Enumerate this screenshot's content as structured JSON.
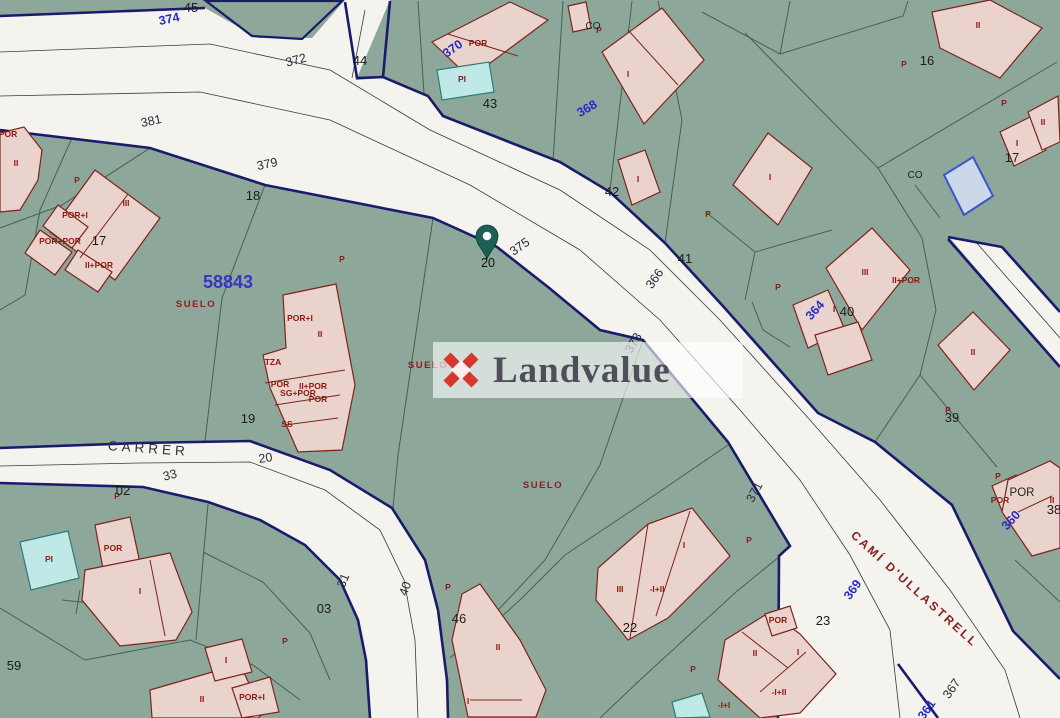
{
  "watermark": {
    "text": "Landvalue",
    "logo_color": "#d6372e",
    "text_color": "#4f4f5c"
  },
  "pin": {
    "label": "20",
    "x": 487,
    "y": 240,
    "color": "#1b5f55"
  },
  "reference_number": {
    "text": "58843",
    "x": 228,
    "y": 288,
    "color": "#3a35c0"
  },
  "street_names": [
    {
      "text": "CARRER",
      "x": 148,
      "y": 453,
      "rot": 4
    },
    {
      "text": "CAMÍ D'ULLASTRELL",
      "x": 912,
      "y": 592,
      "rot": 42
    }
  ],
  "land_use_labels": [
    {
      "text": "SUELO",
      "x": 196,
      "y": 307
    },
    {
      "text": "SUELO",
      "x": 428,
      "y": 368
    },
    {
      "text": "SUELO",
      "x": 543,
      "y": 488
    }
  ],
  "road_numbers": [
    {
      "t": "374",
      "x": 170,
      "y": 23,
      "r": -12,
      "c": "blue"
    },
    {
      "t": "372",
      "x": 297,
      "y": 64,
      "r": -15,
      "c": "dark"
    },
    {
      "t": "381",
      "x": 152,
      "y": 125,
      "r": -12,
      "c": "dark"
    },
    {
      "t": "379",
      "x": 268,
      "y": 168,
      "r": -12,
      "c": "dark"
    },
    {
      "t": "370",
      "x": 455,
      "y": 52,
      "r": -35,
      "c": "blue"
    },
    {
      "t": "368",
      "x": 589,
      "y": 112,
      "r": -30,
      "c": "blue"
    },
    {
      "t": "375",
      "x": 522,
      "y": 250,
      "r": -35,
      "c": "dark"
    },
    {
      "t": "366",
      "x": 658,
      "y": 281,
      "r": -55,
      "c": "dark"
    },
    {
      "t": "373",
      "x": 637,
      "y": 345,
      "r": -60,
      "c": "dark"
    },
    {
      "t": "364",
      "x": 818,
      "y": 313,
      "r": -48,
      "c": "blue"
    },
    {
      "t": "371",
      "x": 758,
      "y": 494,
      "r": -62,
      "c": "dark"
    },
    {
      "t": "369",
      "x": 856,
      "y": 592,
      "r": -55,
      "c": "blue"
    },
    {
      "t": "367",
      "x": 955,
      "y": 691,
      "r": -55,
      "c": "dark"
    },
    {
      "t": "361",
      "x": 930,
      "y": 712,
      "r": -55,
      "c": "blue"
    },
    {
      "t": "360",
      "x": 1014,
      "y": 523,
      "r": -48,
      "c": "blue"
    },
    {
      "t": "20",
      "x": 266,
      "y": 462,
      "r": -8,
      "c": "dark"
    },
    {
      "t": "33",
      "x": 171,
      "y": 479,
      "r": -15,
      "c": "dark"
    },
    {
      "t": "31",
      "x": 347,
      "y": 582,
      "r": -68,
      "c": "dark"
    },
    {
      "t": "40",
      "x": 409,
      "y": 590,
      "r": -70,
      "c": "dark"
    }
  ],
  "parcel_numbers": [
    {
      "t": "45",
      "x": 191,
      "y": 12
    },
    {
      "t": "44",
      "x": 360,
      "y": 65
    },
    {
      "t": "43",
      "x": 490,
      "y": 108
    },
    {
      "t": "42",
      "x": 612,
      "y": 196
    },
    {
      "t": "41",
      "x": 685,
      "y": 263
    },
    {
      "t": "40",
      "x": 847,
      "y": 316
    },
    {
      "t": "39",
      "x": 952,
      "y": 422
    },
    {
      "t": "16",
      "x": 927,
      "y": 65
    },
    {
      "t": "17",
      "x": 1012,
      "y": 162
    },
    {
      "t": "17",
      "x": 99,
      "y": 245
    },
    {
      "t": "18",
      "x": 253,
      "y": 200
    },
    {
      "t": "19",
      "x": 248,
      "y": 423
    },
    {
      "t": "02",
      "x": 123,
      "y": 495
    },
    {
      "t": "03",
      "x": 324,
      "y": 613
    },
    {
      "t": "59",
      "x": 14,
      "y": 670
    },
    {
      "t": "46",
      "x": 459,
      "y": 623
    },
    {
      "t": "23",
      "x": 823,
      "y": 625
    },
    {
      "t": "22",
      "x": 630,
      "y": 632
    },
    {
      "t": "38",
      "x": 1054,
      "y": 514
    }
  ],
  "pin_parcel_number": {
    "t": "20",
    "x": 488,
    "y": 267
  },
  "co_labels": [
    {
      "t": "CO",
      "x": 593,
      "y": 29
    },
    {
      "t": "CO",
      "x": 915,
      "y": 178
    }
  ],
  "por_black_label": {
    "t": "POR",
    "x": 1022,
    "y": 496
  },
  "building_labels": [
    {
      "t": "POR",
      "x": 8,
      "y": 137
    },
    {
      "t": "II",
      "x": 16,
      "y": 166
    },
    {
      "t": "P",
      "x": 77,
      "y": 183
    },
    {
      "t": "III",
      "x": 126,
      "y": 206
    },
    {
      "t": "POR+I",
      "x": 75,
      "y": 218
    },
    {
      "t": "POR+POR",
      "x": 60,
      "y": 244
    },
    {
      "t": "II+POR",
      "x": 99,
      "y": 268
    },
    {
      "t": "POR+I",
      "x": 300,
      "y": 321
    },
    {
      "t": "II",
      "x": 320,
      "y": 337
    },
    {
      "t": "TZA",
      "x": 273,
      "y": 365
    },
    {
      "t": "POR",
      "x": 280,
      "y": 387
    },
    {
      "t": "II+POR",
      "x": 313,
      "y": 389
    },
    {
      "t": "SG+POR",
      "x": 298,
      "y": 396
    },
    {
      "t": "POR",
      "x": 318,
      "y": 402
    },
    {
      "t": "SS",
      "x": 287,
      "y": 427
    },
    {
      "t": "P",
      "x": 342,
      "y": 262
    },
    {
      "t": "POR",
      "x": 478,
      "y": 46
    },
    {
      "t": "PI",
      "x": 462,
      "y": 82
    },
    {
      "t": "P",
      "x": 599,
      "y": 33
    },
    {
      "t": "I",
      "x": 628,
      "y": 77
    },
    {
      "t": "I",
      "x": 638,
      "y": 182
    },
    {
      "t": "P",
      "x": 708,
      "y": 217
    },
    {
      "t": "I",
      "x": 770,
      "y": 180
    },
    {
      "t": "P",
      "x": 904,
      "y": 67
    },
    {
      "t": "II",
      "x": 978,
      "y": 28
    },
    {
      "t": "P",
      "x": 1004,
      "y": 106
    },
    {
      "t": "II",
      "x": 1043,
      "y": 125
    },
    {
      "t": "I",
      "x": 1017,
      "y": 146
    },
    {
      "t": "P",
      "x": 778,
      "y": 290
    },
    {
      "t": "III",
      "x": 865,
      "y": 275
    },
    {
      "t": "II+POR",
      "x": 906,
      "y": 283
    },
    {
      "t": "I",
      "x": 834,
      "y": 312
    },
    {
      "t": "P",
      "x": 948,
      "y": 413
    },
    {
      "t": "II",
      "x": 973,
      "y": 355
    },
    {
      "t": "P",
      "x": 998,
      "y": 479
    },
    {
      "t": "POR",
      "x": 1000,
      "y": 503
    },
    {
      "t": "II",
      "x": 1052,
      "y": 503
    },
    {
      "t": "PI",
      "x": 49,
      "y": 562
    },
    {
      "t": "POR",
      "x": 113,
      "y": 551
    },
    {
      "t": "I",
      "x": 140,
      "y": 594
    },
    {
      "t": "I",
      "x": 226,
      "y": 663
    },
    {
      "t": "II",
      "x": 202,
      "y": 702
    },
    {
      "t": "POR+I",
      "x": 252,
      "y": 700
    },
    {
      "t": "P",
      "x": 117,
      "y": 499
    },
    {
      "t": "P",
      "x": 285,
      "y": 644
    },
    {
      "t": "P",
      "x": 448,
      "y": 590
    },
    {
      "t": "II",
      "x": 498,
      "y": 650
    },
    {
      "t": "I",
      "x": 468,
      "y": 704
    },
    {
      "t": "I",
      "x": 684,
      "y": 548
    },
    {
      "t": "III",
      "x": 620,
      "y": 592
    },
    {
      "t": "-I+II",
      "x": 657,
      "y": 592
    },
    {
      "t": "P",
      "x": 693,
      "y": 672
    },
    {
      "t": "P",
      "x": 749,
      "y": 543
    },
    {
      "t": "POR",
      "x": 778,
      "y": 623
    },
    {
      "t": "II",
      "x": 755,
      "y": 656
    },
    {
      "t": "I",
      "x": 798,
      "y": 655
    },
    {
      "t": "-I+II",
      "x": 779,
      "y": 695
    },
    {
      "t": "-I+I",
      "x": 724,
      "y": 708
    }
  ],
  "colors": {
    "land": "#8da89a",
    "road": "#f4f3ee",
    "road_border": "#1b1b6b",
    "building": "#ead3cd",
    "building_border": "#7c241a",
    "pool": "#bfe9e6",
    "pool_border": "#2f7a7a",
    "blue_pool_border": "#3a56c8",
    "parcel_line": "#47604f"
  }
}
